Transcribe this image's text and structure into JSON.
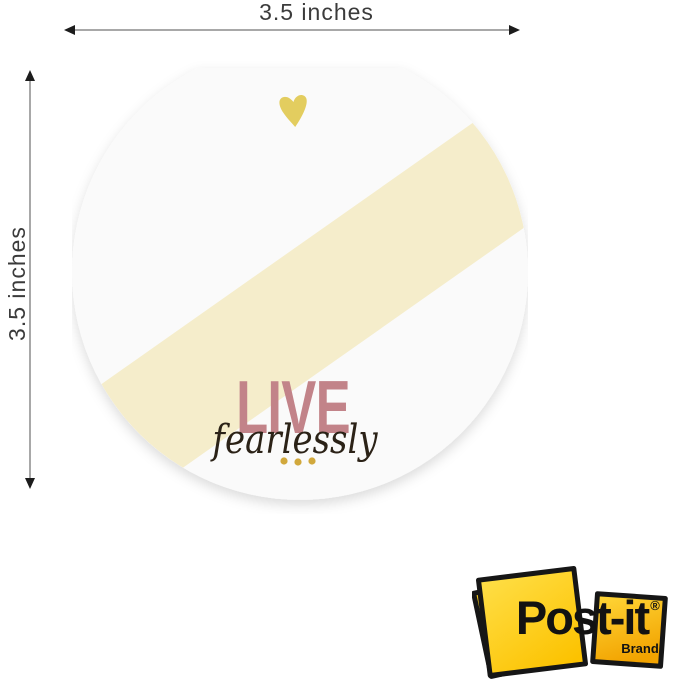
{
  "dimension_labels": {
    "width": "3.5 inches",
    "height": "3.5 inches"
  },
  "note": {
    "title": "LIVE",
    "subtitle": "fearlessly",
    "colors": {
      "fill": "#fafafa",
      "stripe": "#f5edcb",
      "title_text": "#c28389",
      "subtitle_text": "#2b2217",
      "heart": "#e3cd5f",
      "dots": "#d1a83c"
    }
  },
  "brand_logo": {
    "name": "Post-it",
    "registered_mark": "®",
    "brand_word": "Brand",
    "colors": {
      "back_note": "#f2c51d",
      "middle_note": "#ffd629",
      "outline": "#161616",
      "text": "#121212"
    }
  }
}
